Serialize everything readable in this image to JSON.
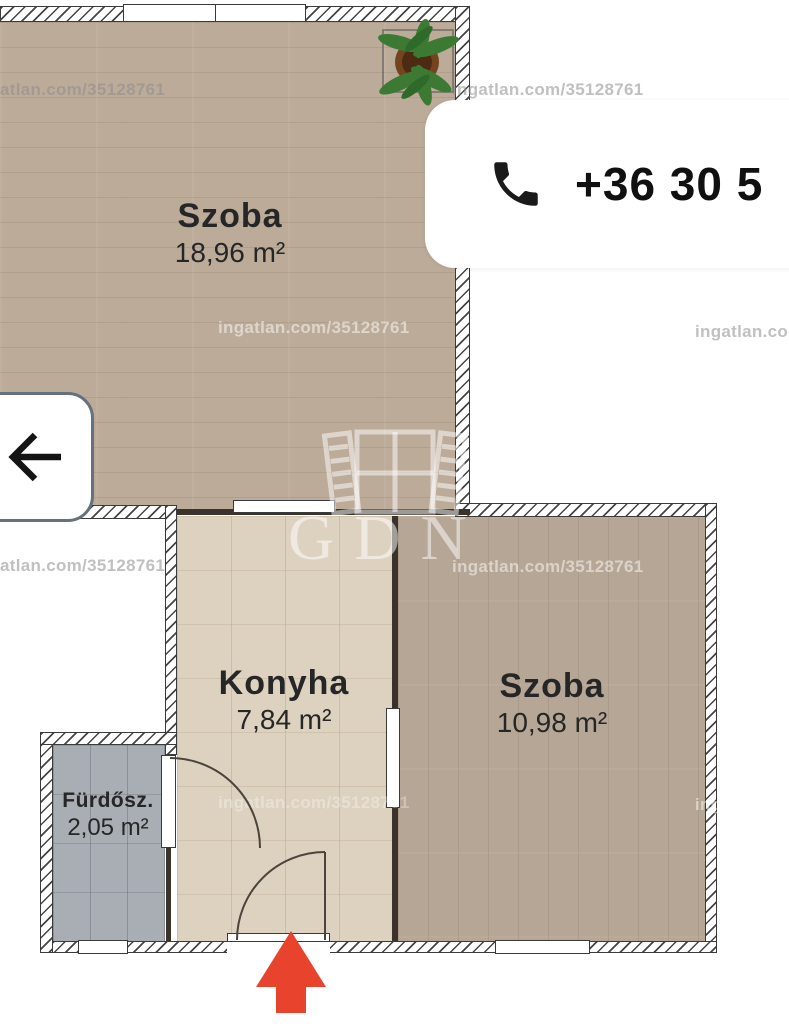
{
  "phone": {
    "number": "+36 30 5"
  },
  "rooms": [
    {
      "name": "Szoba",
      "area": "18,96 m²"
    },
    {
      "name": "Konyha",
      "area": "7,84 m²"
    },
    {
      "name": "Szoba",
      "area": "10,98 m²"
    },
    {
      "name": "Fürdősz.",
      "area": "2,05 m²"
    }
  ],
  "watermark": {
    "full": "ingatlan.com/35128761",
    "left_cut": "atlan.com/35128761",
    "right_cut": "ingatlan.com/3"
  },
  "logo": {
    "text": "GDN"
  },
  "colors": {
    "entrance_arrow": "#e8432c",
    "phone_text": "#101010",
    "floor_wood": "#bcab99",
    "floor_wood_small": "#b6a695",
    "floor_tile": "#ddd2c0",
    "floor_bath": "#a9aeb5"
  }
}
